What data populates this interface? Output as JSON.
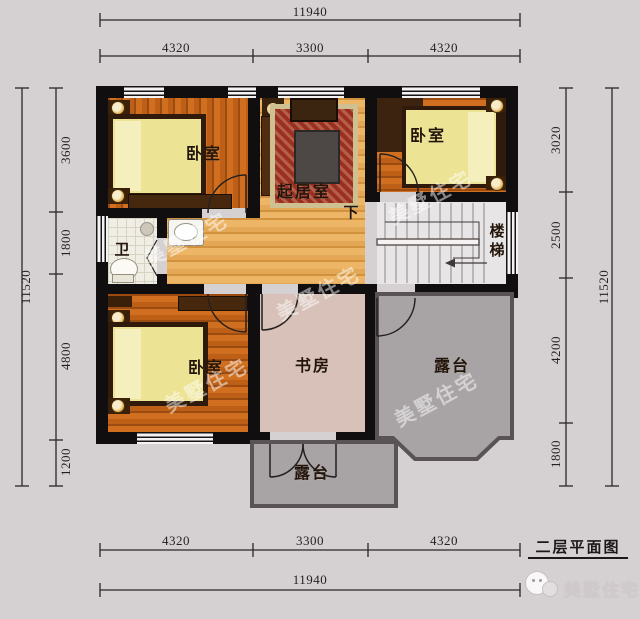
{
  "plan": {
    "title": "二层平面图",
    "brand": "美墅住宅",
    "watermark": "美墅住宅"
  },
  "dimensions": {
    "top": {
      "total": "11940",
      "segments": [
        "4320",
        "3300",
        "4320"
      ]
    },
    "bottom": {
      "total": "11940",
      "segments": [
        "4320",
        "3300",
        "4320"
      ]
    },
    "left": {
      "total": "11520",
      "segments": [
        "3600",
        "1800",
        "4800",
        "1200"
      ]
    },
    "right": {
      "total": "11520",
      "segments": [
        "3020",
        "2500",
        "4200",
        "1800"
      ]
    }
  },
  "rooms": {
    "bedroom_top_left": "卧室",
    "bedroom_top_right": "卧室",
    "bedroom_bottom_left": "卧室",
    "living_room": "起居室",
    "study": "书房",
    "bathroom": "卫",
    "stairs": "楼梯",
    "stairs_down": "下",
    "terrace_right": "露台",
    "terrace_bottom": "露台"
  },
  "colors": {
    "background": "#d5d1d3",
    "wall": "#100e0f",
    "wood_dark": "#c4661b",
    "wood_light": "#e9af5c",
    "tile": "#f0eee4",
    "study_floor": "#d7c1b9",
    "stairs": "#e8e5e7",
    "terrace": "#a8a3a5",
    "terrace_border": "#5a5356",
    "mattress": "#ece395",
    "rug": "#9c2f23",
    "furniture_wood": "#46280f",
    "dimension_text": "#241f21"
  }
}
